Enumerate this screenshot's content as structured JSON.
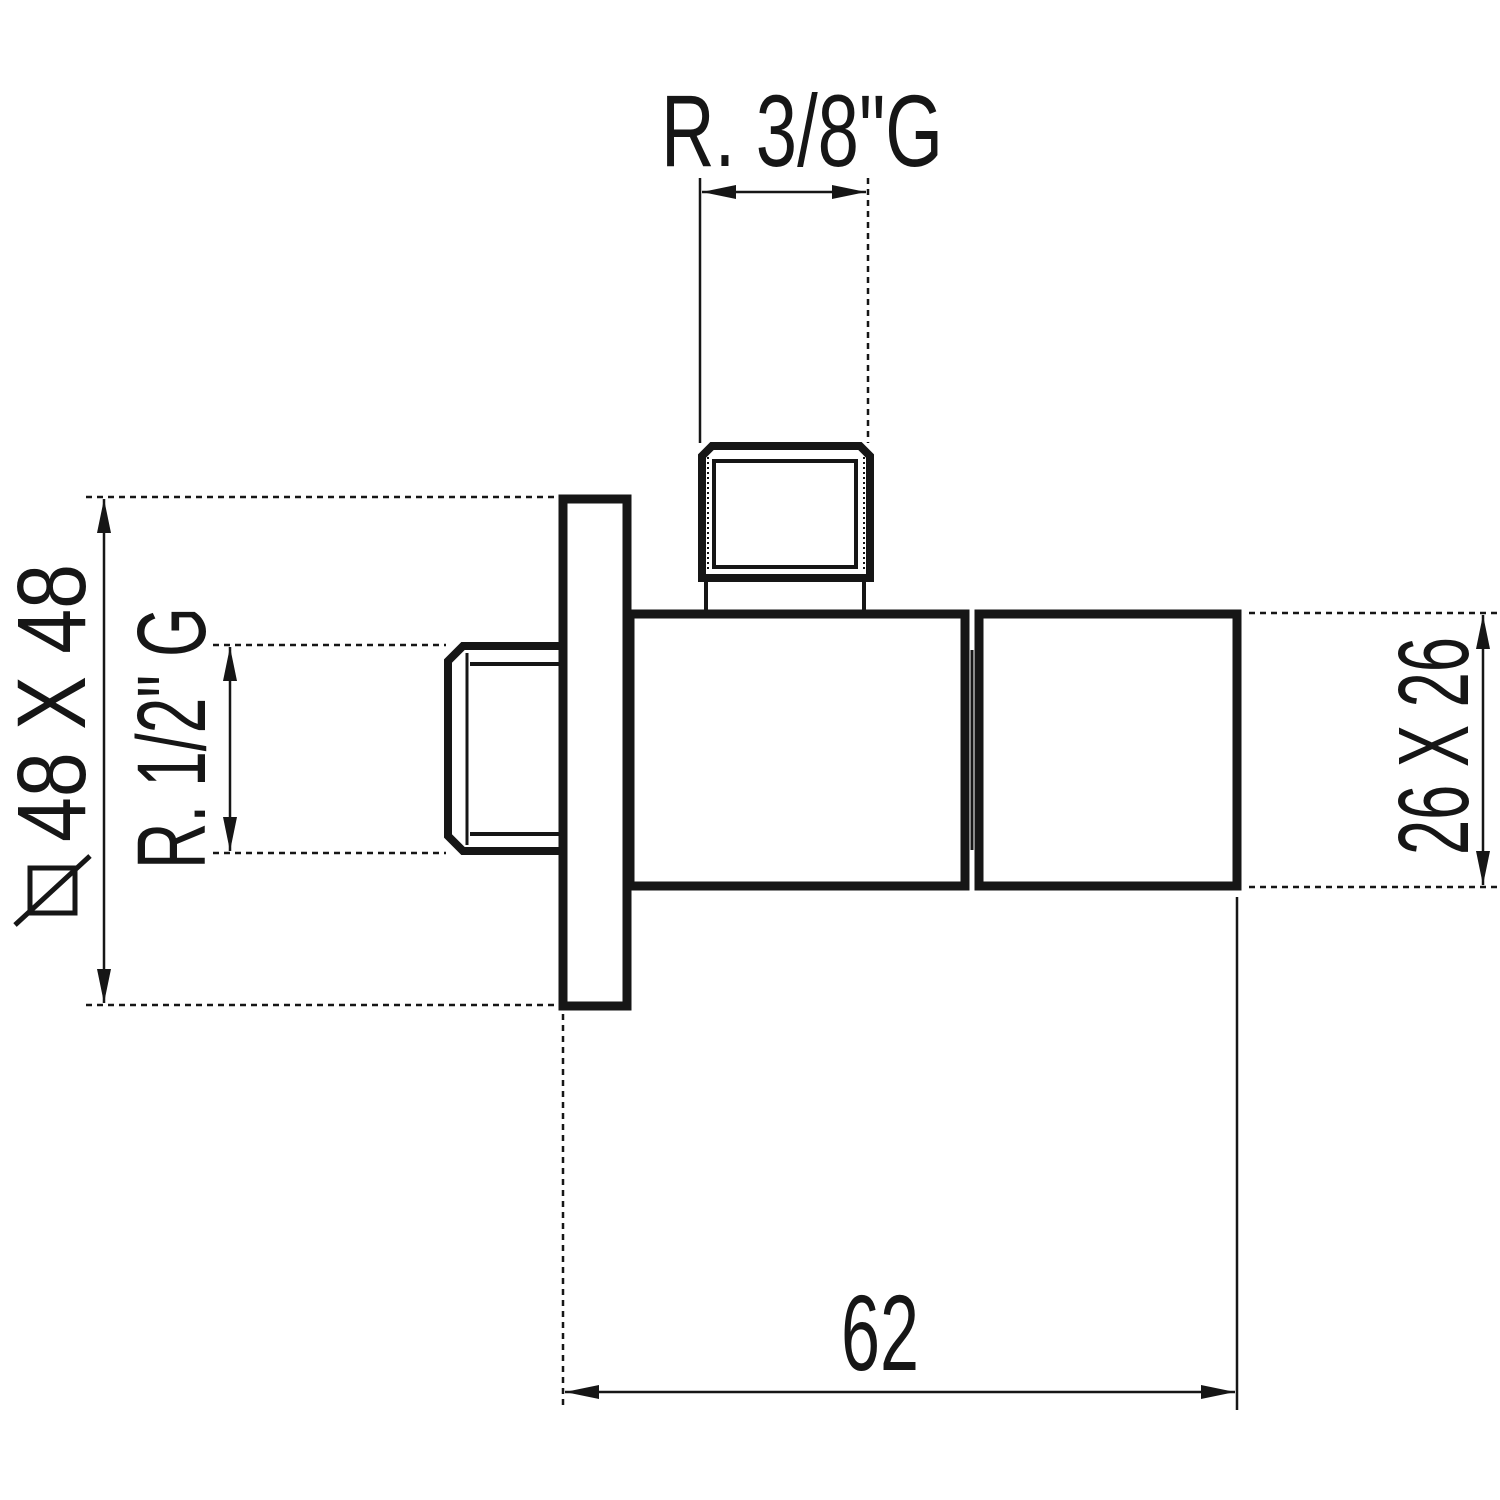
{
  "page": {
    "background": "#ffffff",
    "line_color": "#161616"
  },
  "drawing": {
    "type": "technical-dimension-drawing",
    "subject": "angle-valve-side-elevation",
    "parts": [
      "top-outlet-thread",
      "left-inlet-thread",
      "wall-plate",
      "valve-body",
      "valve-handle"
    ],
    "dimensions": {
      "top_thread": {
        "label": "R. 3/8\"G",
        "orientation": "horizontal"
      },
      "plate_square": {
        "label": "48 X 48",
        "orientation": "vertical",
        "symbol": "square-section-icon"
      },
      "inlet_thread": {
        "label": "R. 1/2\" G",
        "orientation": "vertical"
      },
      "handle_square": {
        "label": "26 X 26",
        "orientation": "vertical"
      },
      "body_depth": {
        "label": "62",
        "orientation": "horizontal"
      }
    }
  }
}
